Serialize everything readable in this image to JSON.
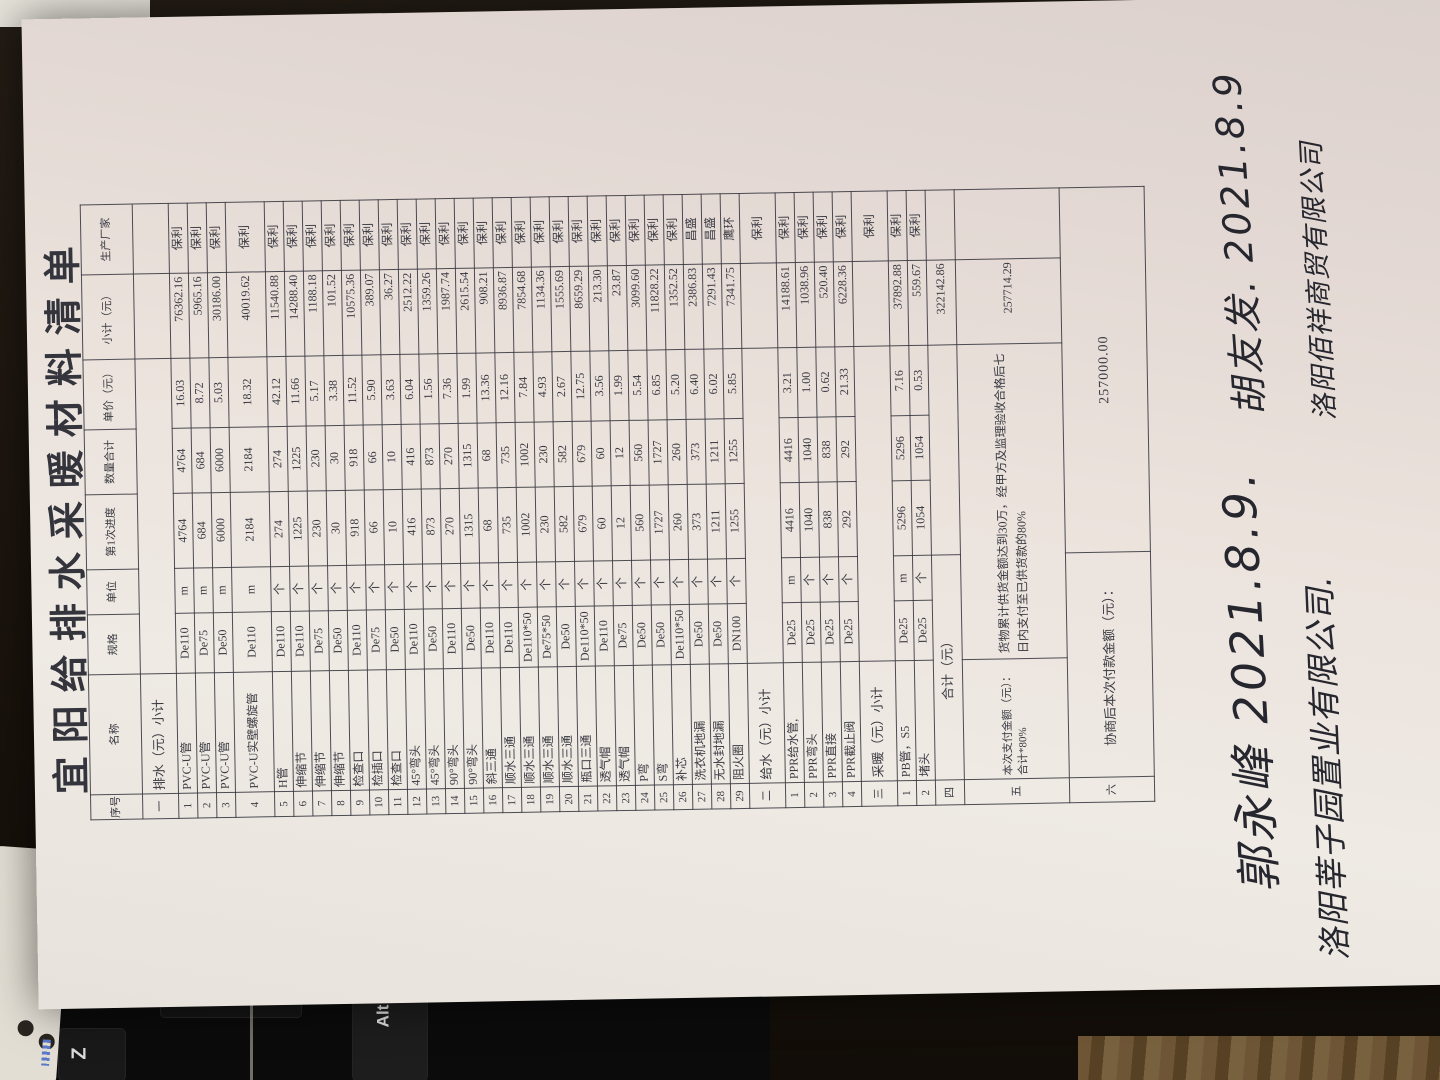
{
  "paper": {
    "title": "宜阳给排水采暖材料清单"
  },
  "table": {
    "columns": [
      "序号",
      "名称",
      "规格",
      "单位",
      "第1次进度",
      "数量合计",
      "单价（元）",
      "小计（元）",
      "生产厂家"
    ],
    "rows": [
      {
        "t": "h"
      },
      {
        "t": "sec",
        "no": "一",
        "name": "排水（元）小计",
        "vendor": ""
      },
      {
        "t": "item",
        "no": "1",
        "name": "PVC-U管",
        "spec": "De110",
        "unit": "m",
        "q1": "4764",
        "q2": "4764",
        "price": "16.03",
        "sub": "76362.16",
        "vendor": "保利"
      },
      {
        "t": "item",
        "no": "2",
        "name": "PVC-U管",
        "spec": "De75",
        "unit": "m",
        "q1": "684",
        "q2": "684",
        "price": "8.72",
        "sub": "5965.16",
        "vendor": "保利"
      },
      {
        "t": "item",
        "no": "3",
        "name": "PVC-U管",
        "spec": "De50",
        "unit": "m",
        "q1": "6000",
        "q2": "6000",
        "price": "5.03",
        "sub": "30186.00",
        "vendor": "保利"
      },
      {
        "t": "item",
        "tall": true,
        "no": "4",
        "name": "PVC-U实壁螺旋管",
        "spec": "De110",
        "unit": "m",
        "q1": "2184",
        "q2": "2184",
        "price": "18.32",
        "sub": "40019.62",
        "vendor": "保利"
      },
      {
        "t": "item",
        "no": "5",
        "name": "H管",
        "spec": "De110",
        "unit": "个",
        "q1": "274",
        "q2": "274",
        "price": "42.12",
        "sub": "11540.88",
        "vendor": "保利"
      },
      {
        "t": "item",
        "no": "6",
        "name": "伸缩节",
        "spec": "De110",
        "unit": "个",
        "q1": "1225",
        "q2": "1225",
        "price": "11.66",
        "sub": "14288.40",
        "vendor": "保利"
      },
      {
        "t": "item",
        "no": "7",
        "name": "伸缩节",
        "spec": "De75",
        "unit": "个",
        "q1": "230",
        "q2": "230",
        "price": "5.17",
        "sub": "1188.18",
        "vendor": "保利"
      },
      {
        "t": "item",
        "no": "8",
        "name": "伸缩节",
        "spec": "De50",
        "unit": "个",
        "q1": "30",
        "q2": "30",
        "price": "3.38",
        "sub": "101.52",
        "vendor": "保利"
      },
      {
        "t": "item",
        "no": "9",
        "name": "检查口",
        "spec": "De110",
        "unit": "个",
        "q1": "918",
        "q2": "918",
        "price": "11.52",
        "sub": "10575.36",
        "vendor": "保利"
      },
      {
        "t": "item",
        "no": "10",
        "name": "检插口",
        "spec": "De75",
        "unit": "个",
        "q1": "66",
        "q2": "66",
        "price": "5.90",
        "sub": "389.07",
        "vendor": "保利"
      },
      {
        "t": "item",
        "no": "11",
        "name": "检查口",
        "spec": "De50",
        "unit": "个",
        "q1": "10",
        "q2": "10",
        "price": "3.63",
        "sub": "36.27",
        "vendor": "保利"
      },
      {
        "t": "item",
        "no": "12",
        "name": "45°弯头",
        "spec": "De110",
        "unit": "个",
        "q1": "416",
        "q2": "416",
        "price": "6.04",
        "sub": "2512.22",
        "vendor": "保利"
      },
      {
        "t": "item",
        "no": "13",
        "name": "45°弯头",
        "spec": "De50",
        "unit": "个",
        "q1": "873",
        "q2": "873",
        "price": "1.56",
        "sub": "1359.26",
        "vendor": "保利"
      },
      {
        "t": "item",
        "no": "14",
        "name": "90°弯头",
        "spec": "De110",
        "unit": "个",
        "q1": "270",
        "q2": "270",
        "price": "7.36",
        "sub": "1987.74",
        "vendor": "保利"
      },
      {
        "t": "item",
        "no": "15",
        "name": "90°弯头",
        "spec": "De50",
        "unit": "个",
        "q1": "1315",
        "q2": "1315",
        "price": "1.99",
        "sub": "2615.54",
        "vendor": "保利"
      },
      {
        "t": "item",
        "no": "16",
        "name": "斜三通",
        "spec": "De110",
        "unit": "个",
        "q1": "68",
        "q2": "68",
        "price": "13.36",
        "sub": "908.21",
        "vendor": "保利"
      },
      {
        "t": "item",
        "no": "17",
        "name": "顺水三通",
        "spec": "De110",
        "unit": "个",
        "q1": "735",
        "q2": "735",
        "price": "12.16",
        "sub": "8936.87",
        "vendor": "保利"
      },
      {
        "t": "item",
        "no": "18",
        "name": "顺水三通",
        "spec": "De110*50",
        "unit": "个",
        "q1": "1002",
        "q2": "1002",
        "price": "7.84",
        "sub": "7854.68",
        "vendor": "保利"
      },
      {
        "t": "item",
        "no": "19",
        "name": "顺水三通",
        "spec": "De75*50",
        "unit": "个",
        "q1": "230",
        "q2": "230",
        "price": "4.93",
        "sub": "1134.36",
        "vendor": "保利"
      },
      {
        "t": "item",
        "no": "20",
        "name": "顺水三通",
        "spec": "De50",
        "unit": "个",
        "q1": "582",
        "q2": "582",
        "price": "2.67",
        "sub": "1555.69",
        "vendor": "保利"
      },
      {
        "t": "item",
        "no": "21",
        "name": "瓶口三通",
        "spec": "De110*50",
        "unit": "个",
        "q1": "679",
        "q2": "679",
        "price": "12.75",
        "sub": "8659.29",
        "vendor": "保利"
      },
      {
        "t": "item",
        "no": "22",
        "name": "透气帽",
        "spec": "De110",
        "unit": "个",
        "q1": "60",
        "q2": "60",
        "price": "3.56",
        "sub": "213.30",
        "vendor": "保利"
      },
      {
        "t": "item",
        "no": "23",
        "name": "透气帽",
        "spec": "De75",
        "unit": "个",
        "q1": "12",
        "q2": "12",
        "price": "1.99",
        "sub": "23.87",
        "vendor": "保利"
      },
      {
        "t": "item",
        "no": "24",
        "name": "P弯",
        "spec": "De50",
        "unit": "个",
        "q1": "560",
        "q2": "560",
        "price": "5.54",
        "sub": "3099.60",
        "vendor": "保利"
      },
      {
        "t": "item",
        "no": "25",
        "name": "S弯",
        "spec": "De50",
        "unit": "个",
        "q1": "1727",
        "q2": "1727",
        "price": "6.85",
        "sub": "11828.22",
        "vendor": "保利"
      },
      {
        "t": "item",
        "no": "26",
        "name": "补芯",
        "spec": "De110*50",
        "unit": "个",
        "q1": "260",
        "q2": "260",
        "price": "5.20",
        "sub": "1352.52",
        "vendor": "保利"
      },
      {
        "t": "item",
        "no": "27",
        "name": "洗衣机地漏",
        "spec": "De50",
        "unit": "个",
        "q1": "373",
        "q2": "373",
        "price": "6.40",
        "sub": "2386.83",
        "vendor": "昌盛"
      },
      {
        "t": "item",
        "no": "28",
        "name": "无水封地漏",
        "spec": "De50",
        "unit": "个",
        "q1": "1211",
        "q2": "1211",
        "price": "6.02",
        "sub": "7291.43",
        "vendor": "昌盛"
      },
      {
        "t": "item",
        "no": "29",
        "name": "阻火圈",
        "spec": "DN100",
        "unit": "个",
        "q1": "1255",
        "q2": "1255",
        "price": "5.85",
        "sub": "7341.75",
        "vendor": "鹰环"
      },
      {
        "t": "sec",
        "no": "二",
        "name": "给水（元）小计",
        "vendor": "保利"
      },
      {
        "t": "item",
        "no": "1",
        "name": "PPR给水管,",
        "spec": "De25",
        "unit": "m",
        "q1": "4416",
        "q2": "4416",
        "price": "3.21",
        "sub": "14188.61",
        "vendor": "保利"
      },
      {
        "t": "item",
        "no": "2",
        "name": "PPR弯头",
        "spec": "De25",
        "unit": "个",
        "q1": "1040",
        "q2": "1040",
        "price": "1.00",
        "sub": "1038.96",
        "vendor": "保利"
      },
      {
        "t": "item",
        "no": "3",
        "name": "PPR直接",
        "spec": "De25",
        "unit": "个",
        "q1": "838",
        "q2": "838",
        "price": "0.62",
        "sub": "520.40",
        "vendor": "保利"
      },
      {
        "t": "item",
        "no": "4",
        "name": "PPR截止阀",
        "spec": "De25",
        "unit": "个",
        "q1": "292",
        "q2": "292",
        "price": "21.33",
        "sub": "6228.36",
        "vendor": "保利"
      },
      {
        "t": "sec",
        "no": "三",
        "name": "采暖（元）小计",
        "vendor": "保利"
      },
      {
        "t": "item",
        "no": "1",
        "name": "PB管，S5",
        "spec": "De25",
        "unit": "m",
        "q1": "5296",
        "q2": "5296",
        "price": "7.16",
        "sub": "37892.88",
        "vendor": "保利"
      },
      {
        "t": "item",
        "no": "2",
        "name": "堵头",
        "spec": "De25",
        "unit": "个",
        "q1": "1054",
        "q2": "1054",
        "price": "0.53",
        "sub": "559.67",
        "vendor": "保利"
      },
      {
        "t": "total",
        "no": "四",
        "name": "合计（元）",
        "sub": "322142.86"
      },
      {
        "t": "pay",
        "no": "五",
        "name": "本次支付金额（元）：合计*80%",
        "note": "货物累计供货金额达到30万，经甲方及监理验收合格后七日内支付至已供货款的80%",
        "sub": "257714.29"
      },
      {
        "t": "fin",
        "no": "六",
        "label": "协商后本次付款金额（元）：",
        "amount": "257000.00"
      }
    ]
  },
  "handwriting": {
    "sign_left": "郭永峰  2021.8.9.",
    "company_left": "洛阳莘子园置业有限公司.",
    "sign_right": "胡友发. 2021.8.9",
    "company_right": "洛阳佰祥商贸有限公司"
  },
  "photo": {
    "key_labels": [
      "Z",
      "Alt"
    ]
  }
}
